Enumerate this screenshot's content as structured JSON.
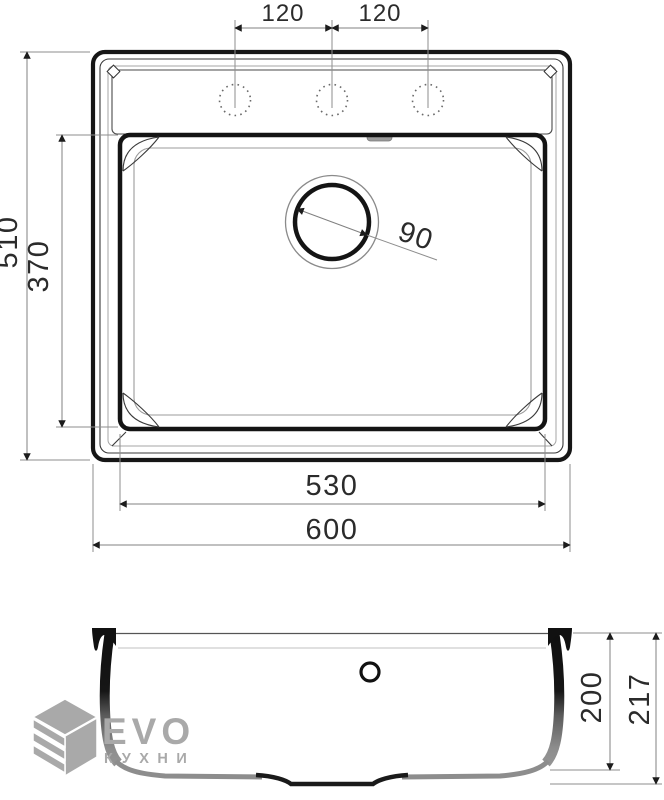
{
  "top_view": {
    "faucet_spacing_left": "120",
    "faucet_spacing_right": "120",
    "outer_height": "510",
    "bowl_height": "370",
    "drain_diameter": "90",
    "bowl_width": "530",
    "outer_width": "600"
  },
  "side_view": {
    "bowl_depth": "200",
    "overall_depth": "217"
  },
  "logo": {
    "brand": "EVO",
    "subtitle": "КУХНИ"
  },
  "colors": {
    "outline": "#161616",
    "thin_line": "#999999",
    "dim_line": "#808080",
    "arrow": "#1c1c1c",
    "text": "#2b2b2b",
    "logo_gray": "#a9a9a9"
  }
}
